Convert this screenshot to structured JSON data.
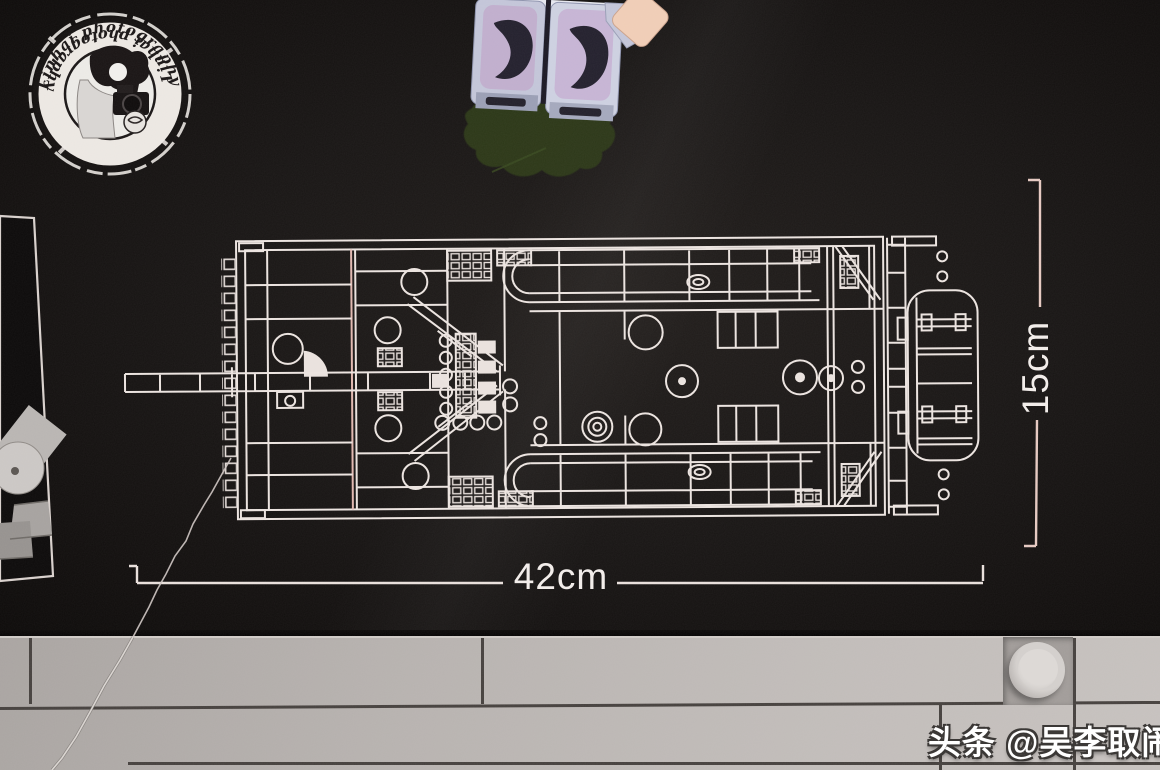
{
  "scene": {
    "subject": "lego-box-top-blueprint-photo",
    "blueprint": "top-view line schematic of LEGO car model"
  },
  "dimension_labels": {
    "width": "42cm",
    "height": "15cm"
  },
  "byline": {
    "text": "头条 @吴李取闹"
  },
  "watermark_stamp": {
    "ring_text_top": "Linhai photography",
    "ring_text_bottom": "Linhai photography"
  },
  "icons": {
    "stamp": "photographer-logo-stamp",
    "stud": "lego-stud"
  },
  "colors": {
    "box_black": "#161312",
    "blueprint_line": "#ebe3df",
    "blueprint_line_pink": "#e0b7af",
    "tile_gray": "#b7b2af",
    "seam_dark": "#46413e",
    "reflection_green": "#2e3b18",
    "minifig_gray": "#c3c5d8",
    "minifig_accent": "#b9a5c9",
    "hand_flesh": "#f0cdb6",
    "text_white": "#f2edea"
  }
}
